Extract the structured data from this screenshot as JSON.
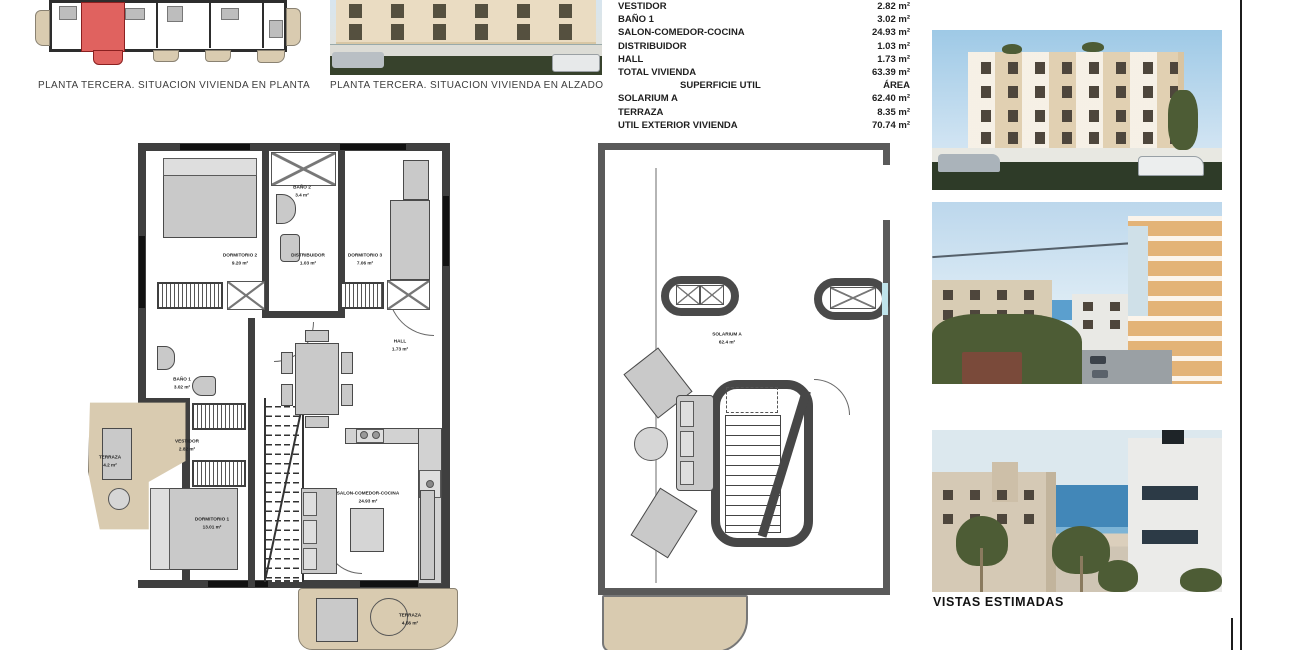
{
  "captions": {
    "keyplan": "PLANTA TERCERA. SITUACION VIVIENDA EN PLANTA",
    "elevation": "PLANTA TERCERA. SITUACION VIVIENDA EN ALZADO",
    "vistas": "VISTAS ESTIMADAS"
  },
  "area_table": {
    "rows": [
      {
        "label": "VESTIDOR",
        "value": "2.82 m²"
      },
      {
        "label": "BAÑO 1",
        "value": "3.02 m²"
      },
      {
        "label": "SALON-COMEDOR-COCINA",
        "value": "24.93 m²"
      },
      {
        "label": "DISTRIBUIDOR",
        "value": "1.03 m²"
      },
      {
        "label": "HALL",
        "value": "1.73 m²"
      },
      {
        "label": "TOTAL VIVIENDA",
        "value": "63.39 m²"
      }
    ],
    "section_header": {
      "label": "SUPERFICIE UTIL",
      "value": "ÁREA"
    },
    "exterior_rows": [
      {
        "label": "SOLARIUM A",
        "value": "62.40 m²"
      },
      {
        "label": "TERRAZA",
        "value": "8.35 m²"
      },
      {
        "label": "UTIL EXTERIOR VIVIENDA",
        "value": "70.74 m²"
      }
    ]
  },
  "floor_plan": {
    "rooms": {
      "dormitorio2": {
        "name": "DORMITORIO 2",
        "area": "9.20 m²"
      },
      "bano2": {
        "name": "BAÑO 2",
        "area": "3.4 m²"
      },
      "dormitorio3": {
        "name": "DORMITORIO 3",
        "area": "7.06 m²"
      },
      "distribuidor": {
        "name": "DISTRIBUIDOR",
        "area": "1.03 m²"
      },
      "bano1": {
        "name": "BAÑO 1",
        "area": "3.02 m²"
      },
      "vestidor": {
        "name": "VESTIDOR",
        "area": "2.82 m²"
      },
      "terraza_lateral": {
        "name": "TERRAZA",
        "area": "4.2 m²"
      },
      "hall": {
        "name": "HALL",
        "area": "1.73 m²"
      },
      "dormitorio1": {
        "name": "DORMITORIO 1",
        "area": "13.01 m²"
      },
      "salon": {
        "name": "SALON-COMEDOR-COCINA",
        "area": "24.93 m²"
      },
      "terraza_inferior": {
        "name": "TERRAZA",
        "area": "4.56 m²"
      }
    }
  },
  "solarium_plan": {
    "solarium": {
      "name": "SOLARIUM A",
      "area": "62.4 m²"
    }
  },
  "colors": {
    "highlight_unit": "#e0625f",
    "terrace_tan": "#d9cbb0",
    "wall_dark": "#3f3f3f"
  }
}
